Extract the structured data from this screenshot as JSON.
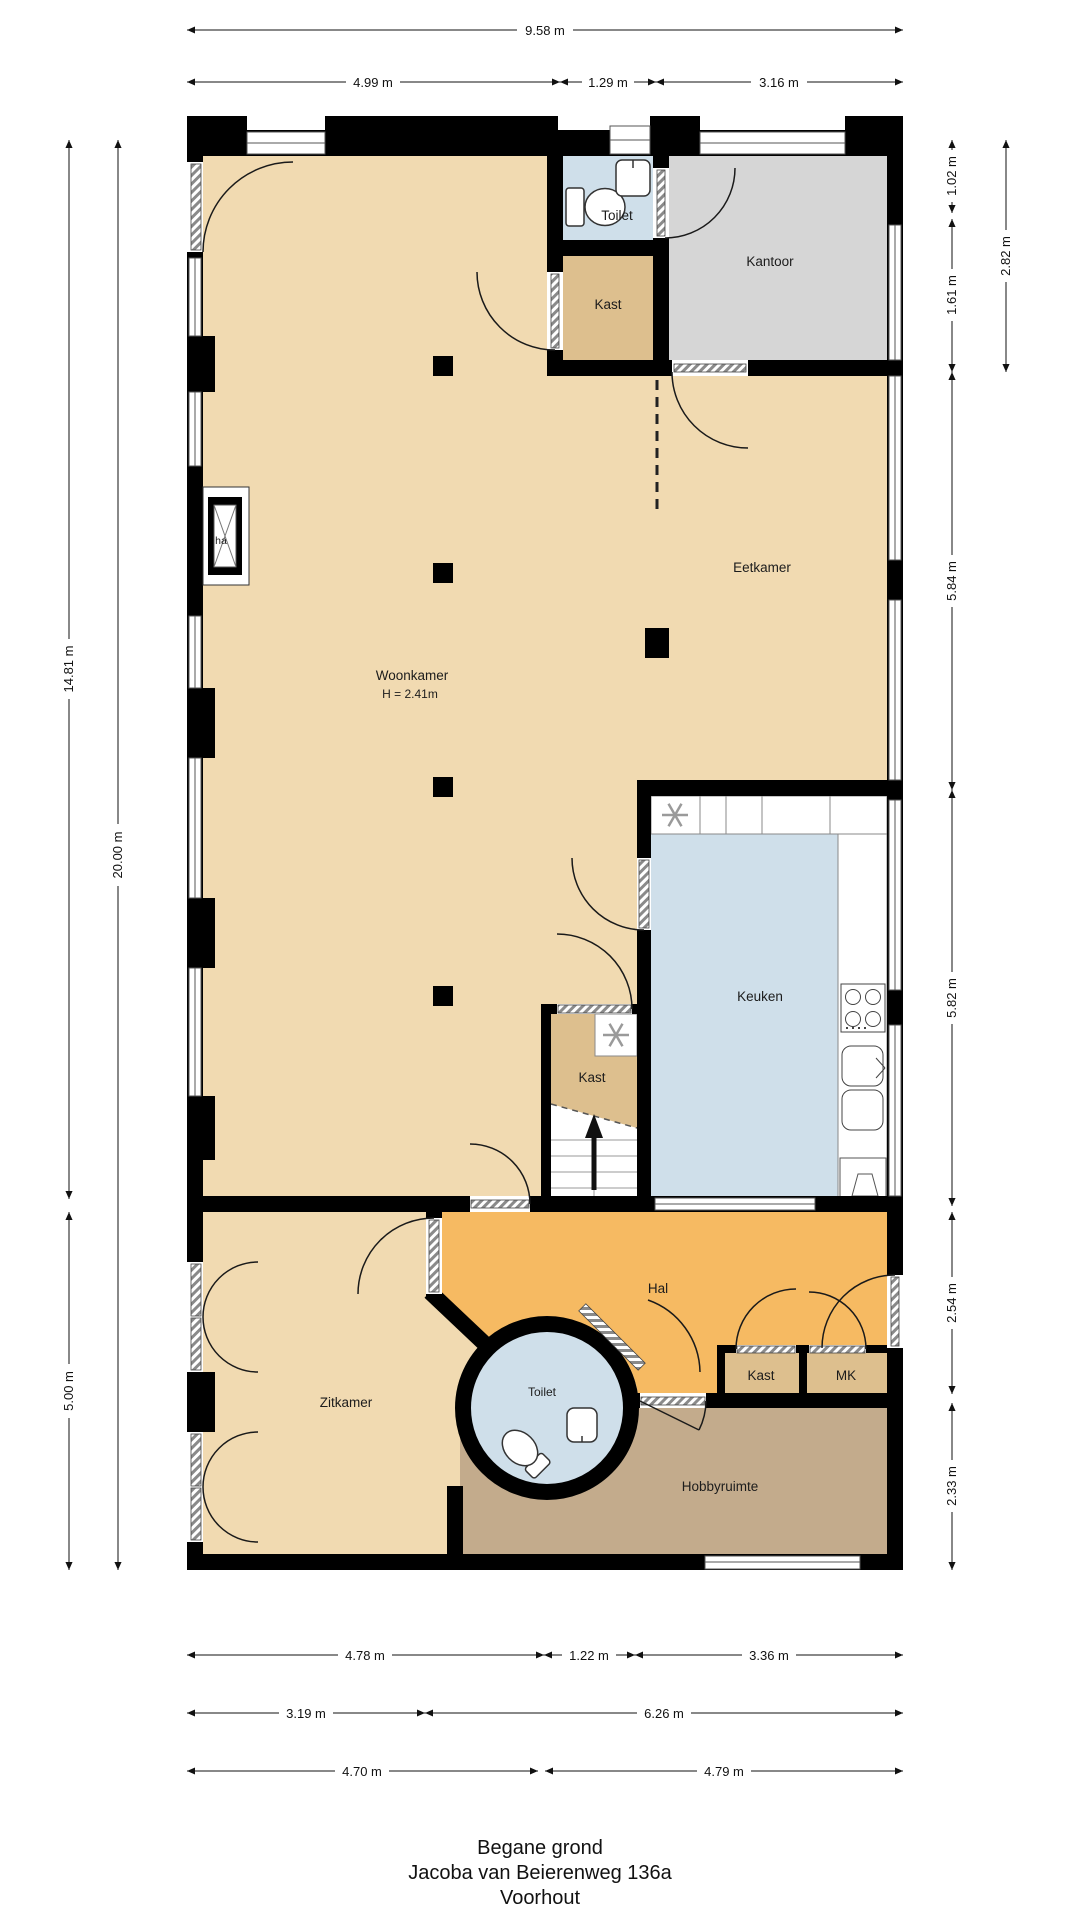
{
  "title": {
    "floor": "Begane grond",
    "street": "Jacoba van Beierenweg 136a",
    "city": "Voorhout"
  },
  "rooms": {
    "woonkamer": {
      "label": "Woonkamer",
      "ceiling_height": "H = 2.41m"
    },
    "eetkamer": {
      "label": "Eetkamer"
    },
    "kantoor": {
      "label": "Kantoor"
    },
    "toilet_top": {
      "label": "Toilet"
    },
    "kast_top": {
      "label": "Kast"
    },
    "keuken": {
      "label": "Keuken"
    },
    "kast_stairs": {
      "label": "Kast"
    },
    "hal": {
      "label": "Hal"
    },
    "zitkamer": {
      "label": "Zitkamer"
    },
    "toilet_round": {
      "label": "Toilet"
    },
    "kast_hal": {
      "label": "Kast"
    },
    "meterkast": {
      "label": "MK"
    },
    "hobbyruimte": {
      "label": "Hobbyruimte"
    },
    "fireplace": {
      "label": "ha"
    }
  },
  "icons": {
    "fan_icon": "✳",
    "stairs_up_arrow": "▲"
  },
  "dimensions": {
    "top": {
      "total": "9.58 m",
      "segments": [
        "4.99 m",
        "1.29 m",
        "3.16 m"
      ]
    },
    "left": {
      "total": "20.00 m",
      "segments": [
        "14.81 m",
        "5.00 m"
      ]
    },
    "right": {
      "outer": "2.82 m",
      "segments": [
        "1.02 m",
        "1.61 m",
        "5.84 m",
        "5.82 m",
        "2.54 m",
        "2.33 m"
      ]
    },
    "bottom": {
      "row1": [
        "4.78 m",
        "1.22 m",
        "3.36 m"
      ],
      "row2": [
        "3.19 m",
        "6.26 m"
      ],
      "row3": [
        "4.70 m",
        "4.79 m"
      ]
    }
  },
  "colors": {
    "wall": "#000000",
    "floor_light": "#F1DAB1",
    "floor_tan": "#DDBF8E",
    "floor_gray": "#D6D6D6",
    "floor_blue": "#CFDFEA",
    "floor_orange": "#F6BA62",
    "floor_brown": "#C3AB8C",
    "window_line": "#555555",
    "dim_line": "#222222"
  }
}
